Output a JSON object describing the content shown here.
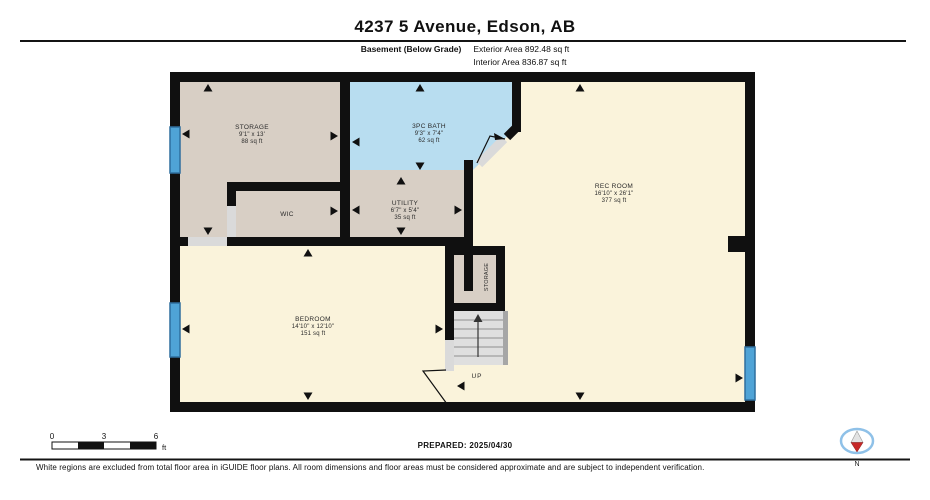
{
  "header": {
    "title": "4237 5 Avenue, Edson, AB",
    "floor_label": "Basement (Below Grade)",
    "exterior_area": "Exterior Area 892.48 sq ft",
    "interior_area": "Interior Area 836.87 sq ft"
  },
  "rooms": {
    "storage": {
      "name": "STORAGE",
      "dims": "9'1\" x 13'",
      "area": "88 sq ft"
    },
    "bath": {
      "name": "3PC BATH",
      "dims": "9'3\" x 7'4\"",
      "area": "62 sq ft"
    },
    "wic": {
      "name": "WIC"
    },
    "utility": {
      "name": "UTILITY",
      "dims": "6'7\" x 5'4\"",
      "area": "35 sq ft"
    },
    "rec_room": {
      "name": "REC ROOM",
      "dims": "16'10\" x 26'1\"",
      "area": "377 sq ft"
    },
    "bedroom": {
      "name": "BEDROOM",
      "dims": "14'10\" x 12'10\"",
      "area": "151 sq ft"
    },
    "closet": {
      "name": "STORAGE"
    },
    "stairs": {
      "label": "UP"
    }
  },
  "scale_bar": {
    "start": "0",
    "mid": "3",
    "end": "6",
    "unit": "ft"
  },
  "footer": {
    "prepared": "PREPARED: 2025/04/30",
    "disclaimer": "White regions are excluded from total floor area in iGUIDE floor plans. All room dimensions and floor areas must be considered approximate and are subject to independent verification.",
    "compass_label": "N"
  },
  "colors": {
    "room_cream": "#FAF3DB",
    "room_tan": "#D8CFC5",
    "room_bath": "#B8DDF0",
    "window_fill": "#4FA3D6",
    "window_stroke": "#2F6E9E",
    "stairs_fill": "#DFDFDF",
    "stairs_edge": "#A6A6A6",
    "compass_red": "#C62828",
    "compass_ring": "#8FC1E8"
  }
}
